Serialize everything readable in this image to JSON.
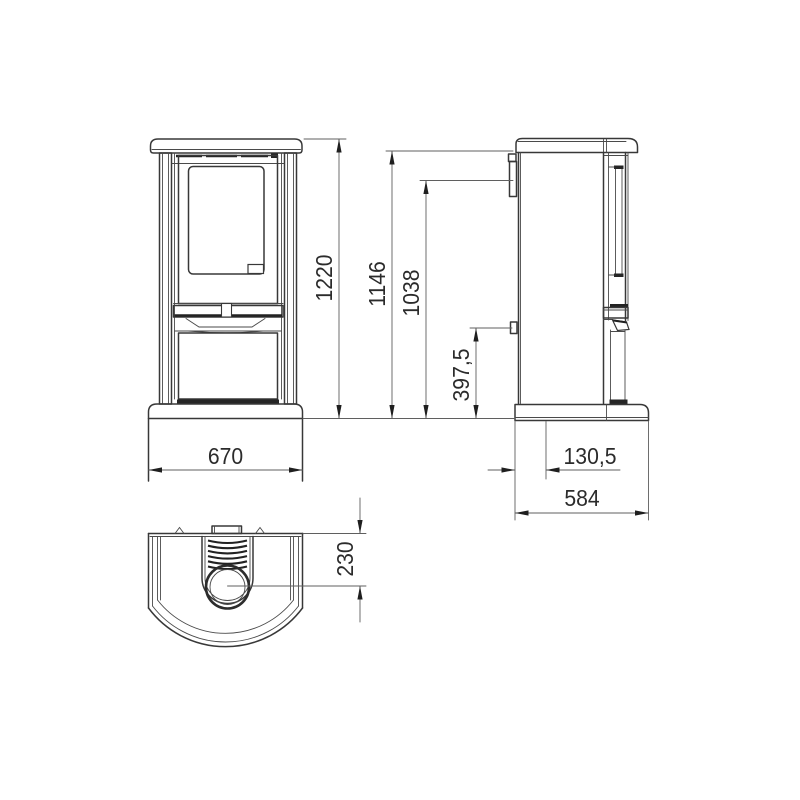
{
  "drawing": {
    "background": "#ffffff",
    "line_color": "#383838",
    "dim_color": "#5f5f5f",
    "text_color": "#2b2b2b",
    "views": {
      "front": {
        "label": "front-view-of-stove"
      },
      "side": {
        "label": "side-view-of-stove"
      },
      "top": {
        "label": "top-view-of-stove"
      }
    },
    "dimensions": {
      "overall_width": "670",
      "overall_height": "1220",
      "flue_outlet_top_height": "1146",
      "rear_flue_center_height": "1038",
      "rear_connection_height": "397,5",
      "flue_center_from_back": "130,5",
      "overall_depth": "584",
      "top_flue_center_from_back": "230"
    }
  }
}
